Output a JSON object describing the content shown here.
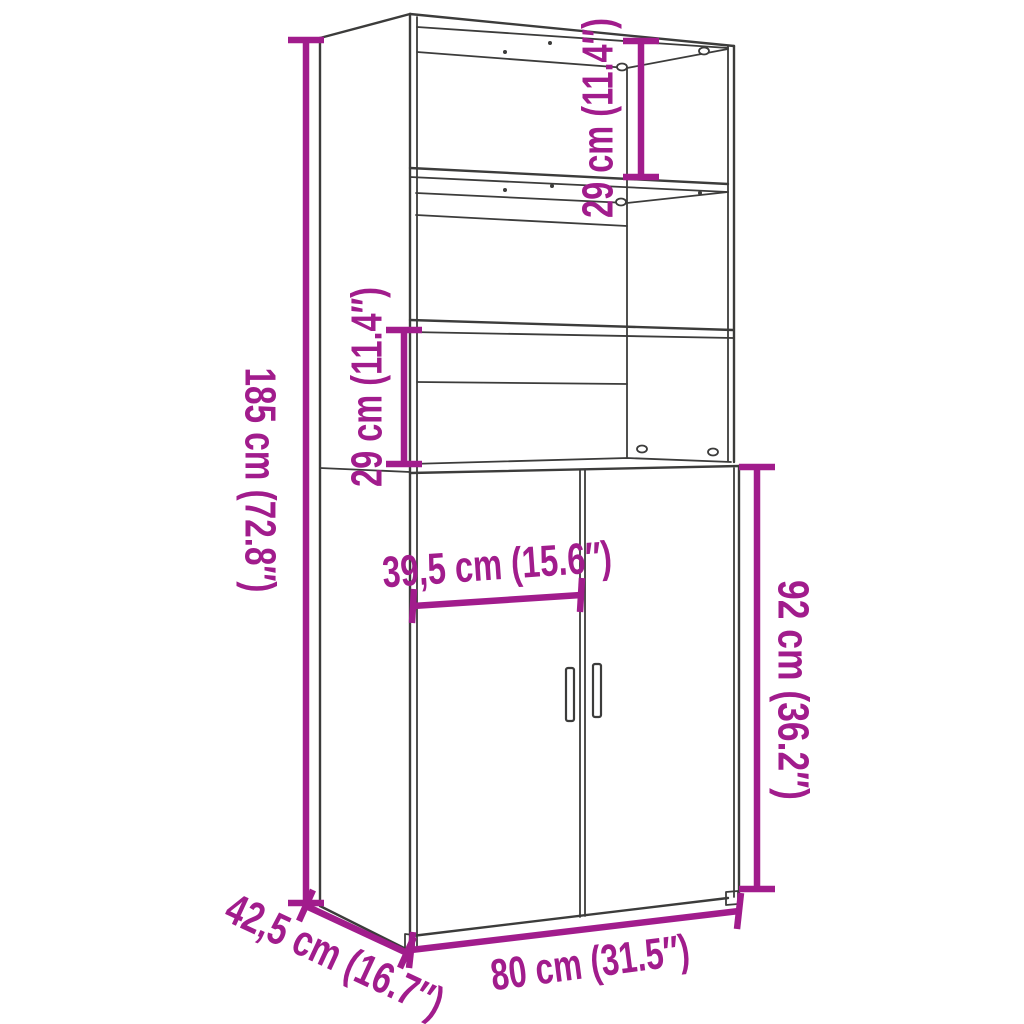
{
  "meta": {
    "type": "furniture-dimension-diagram",
    "subject": "tall highboard cabinet with open shelves on top and two doors below"
  },
  "colors": {
    "dimension": "#A11C8C",
    "line_art": "#3C3C3B",
    "background": "#FFFFFF"
  },
  "dimensions": {
    "overall_height": {
      "label": "185 cm (72.8″)",
      "cm": 185,
      "inches": 72.8
    },
    "top_compartment_height": {
      "label": "29 cm (11.4″)",
      "cm": 29,
      "inches": 11.4
    },
    "middle_compartment_height": {
      "label": "29 cm (11.4″)",
      "cm": 29,
      "inches": 11.4
    },
    "door_width": {
      "label": "39,5 cm (15.6″)",
      "cm": 39.5,
      "inches": 15.6
    },
    "door_section_height": {
      "label": "92 cm (36.2″)",
      "cm": 92,
      "inches": 36.2
    },
    "overall_width": {
      "label": "80 cm (31.5″)",
      "cm": 80,
      "inches": 31.5
    },
    "overall_depth": {
      "label": "42,5 cm (16.7″)",
      "cm": 42.5,
      "inches": 16.7
    }
  }
}
